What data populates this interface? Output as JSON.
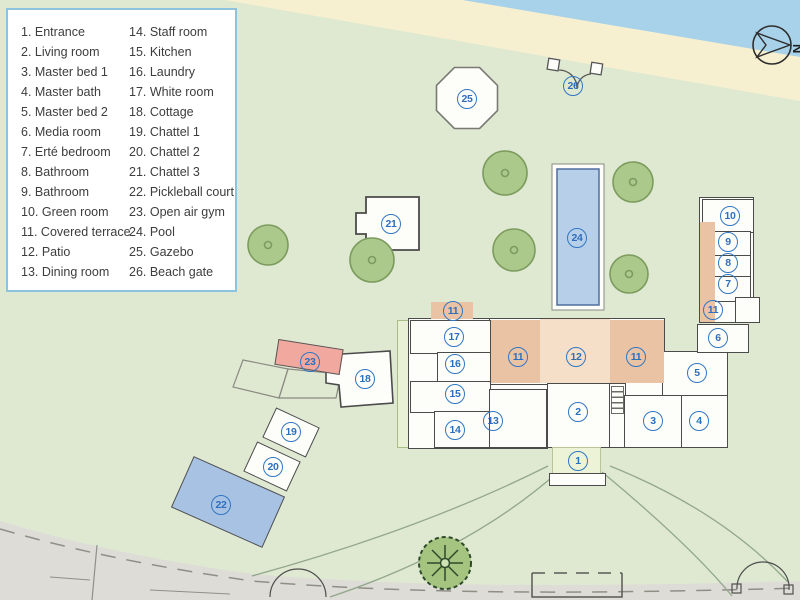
{
  "legend": {
    "items": [
      {
        "num": "1",
        "label": "Entrance"
      },
      {
        "num": "2",
        "label": "Living room"
      },
      {
        "num": "3",
        "label": "Master bed 1"
      },
      {
        "num": "4",
        "label": "Master bath"
      },
      {
        "num": "5",
        "label": "Master bed 2"
      },
      {
        "num": "6",
        "label": "Media room"
      },
      {
        "num": "7",
        "label": "Erté bedroom"
      },
      {
        "num": "8",
        "label": "Bathroom"
      },
      {
        "num": "9",
        "label": "Bathroom"
      },
      {
        "num": "10",
        "label": "Green room"
      },
      {
        "num": "11",
        "label": "Covered terrace"
      },
      {
        "num": "12",
        "label": "Patio"
      },
      {
        "num": "13",
        "label": "Dining room"
      },
      {
        "num": "14",
        "label": "Staff room"
      },
      {
        "num": "15",
        "label": "Kitchen"
      },
      {
        "num": "16",
        "label": "Laundry"
      },
      {
        "num": "17",
        "label": "White room"
      },
      {
        "num": "18",
        "label": "Cottage"
      },
      {
        "num": "19",
        "label": "Chattel 1"
      },
      {
        "num": "20",
        "label": "Chattel 2"
      },
      {
        "num": "21",
        "label": "Chattel 3"
      },
      {
        "num": "22",
        "label": "Pickleball court"
      },
      {
        "num": "23",
        "label": "Open air gym"
      },
      {
        "num": "24",
        "label": "Pool"
      },
      {
        "num": "25",
        "label": "Gazebo"
      },
      {
        "num": "26",
        "label": "Beach gate"
      }
    ]
  },
  "compass": {
    "north_label": "N"
  },
  "markers": [
    {
      "n": "1",
      "x": 578,
      "y": 461
    },
    {
      "n": "2",
      "x": 578,
      "y": 412
    },
    {
      "n": "3",
      "x": 653,
      "y": 421
    },
    {
      "n": "4",
      "x": 699,
      "y": 421
    },
    {
      "n": "5",
      "x": 697,
      "y": 373
    },
    {
      "n": "6",
      "x": 718,
      "y": 338
    },
    {
      "n": "7",
      "x": 728,
      "y": 284
    },
    {
      "n": "8",
      "x": 728,
      "y": 263
    },
    {
      "n": "9",
      "x": 728,
      "y": 242
    },
    {
      "n": "10",
      "x": 730,
      "y": 216
    },
    {
      "n": "11",
      "x": 453,
      "y": 311
    },
    {
      "n": "11",
      "x": 518,
      "y": 357
    },
    {
      "n": "11",
      "x": 636,
      "y": 357
    },
    {
      "n": "11",
      "x": 713,
      "y": 310
    },
    {
      "n": "12",
      "x": 576,
      "y": 357
    },
    {
      "n": "13",
      "x": 493,
      "y": 421
    },
    {
      "n": "14",
      "x": 455,
      "y": 430
    },
    {
      "n": "15",
      "x": 455,
      "y": 394
    },
    {
      "n": "16",
      "x": 455,
      "y": 364
    },
    {
      "n": "17",
      "x": 454,
      "y": 337
    },
    {
      "n": "18",
      "x": 365,
      "y": 379
    },
    {
      "n": "19",
      "x": 291,
      "y": 432
    },
    {
      "n": "20",
      "x": 273,
      "y": 467
    },
    {
      "n": "21",
      "x": 391,
      "y": 224
    },
    {
      "n": "22",
      "x": 221,
      "y": 505
    },
    {
      "n": "23",
      "x": 310,
      "y": 362
    },
    {
      "n": "24",
      "x": 577,
      "y": 238
    },
    {
      "n": "25",
      "x": 467,
      "y": 99
    },
    {
      "n": "26",
      "x": 573,
      "y": 86
    }
  ],
  "colors": {
    "lawn": "#dfe9d1",
    "water": "#a8d2e9",
    "sand": "#f7f0d0",
    "road": "#dddcd6",
    "tree_fill": "#abc98b",
    "tree_stroke": "#7c9b5e",
    "pool": "#b7cfe9",
    "court": "#a8c2e3",
    "terrace": "#eac3a4",
    "patio": "#f6dfc9",
    "gym": "#f1a89e",
    "marker_blue": "#3277c2",
    "legend_border": "#8cc3de",
    "wall": "#4b4b4b"
  }
}
